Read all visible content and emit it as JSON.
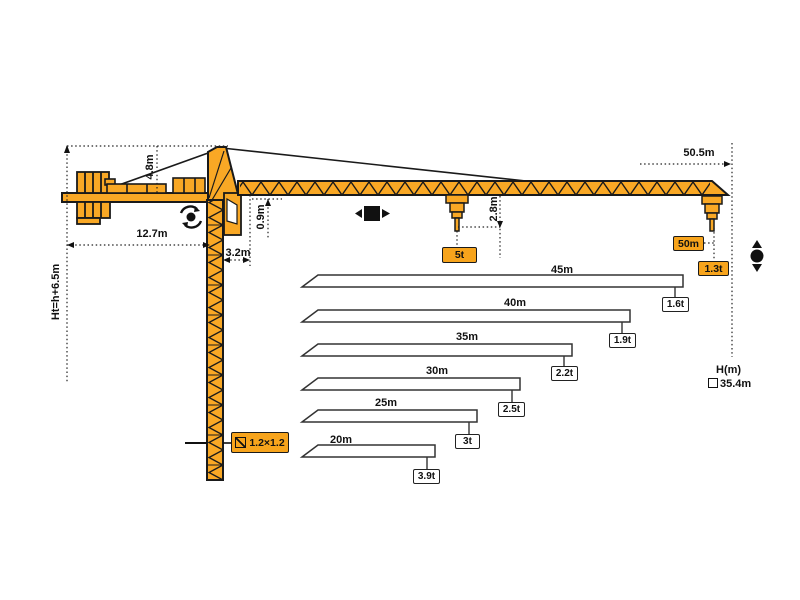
{
  "dimensions": {
    "total_height_formula": "Ht=h+6.5m",
    "counterjib_length": "12.7m",
    "tower_head_height": "4.8m",
    "jib_depth": "0.9m",
    "slew_offset": "3.2m",
    "hook_drop": "2.8m",
    "overall_jib_length": "50.5m"
  },
  "tags": {
    "max_capacity": "5t",
    "max_radius": "50m",
    "tip_capacity": "1.3t",
    "mast_section": "1.2×1.2"
  },
  "height_axis": {
    "label": "H(m)",
    "freestanding_height": "35.4m"
  },
  "load_chart": {
    "type": "bar",
    "bars": [
      {
        "length": "45m",
        "capacity": "1.6t"
      },
      {
        "length": "40m",
        "capacity": "1.9t"
      },
      {
        "length": "35m",
        "capacity": "2.2t"
      },
      {
        "length": "30m",
        "capacity": "2.5t"
      },
      {
        "length": "25m",
        "capacity": "3t"
      },
      {
        "length": "20m",
        "capacity": "3.9t"
      }
    ]
  },
  "icons": {
    "slewing": "rotation-dot-with-arc-arrows",
    "trolley_travel": "black-square-left-right-arrows",
    "hoist": "black-circle-up-down-arrows",
    "mast_section_symbol": "square-with-diagonal",
    "height_marker": "small-outline-square"
  },
  "colors": {
    "crane_yellow": "#F9A825",
    "tag_orange": "#F7A41C",
    "outline_black": "#1a1a1a",
    "background": "#ffffff"
  }
}
